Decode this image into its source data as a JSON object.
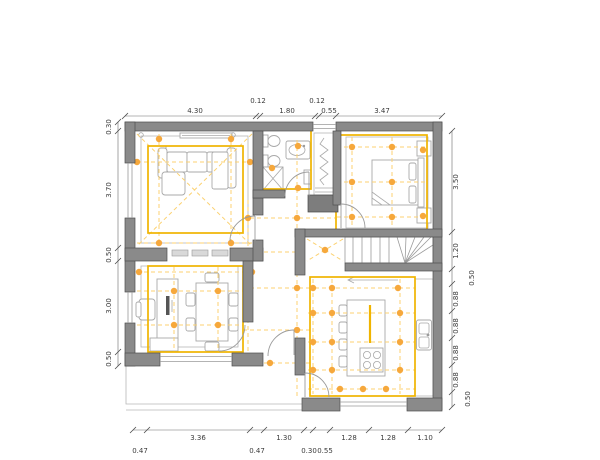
{
  "drawing": {
    "colors": {
      "wall_fill": "#8a8a8a",
      "wall_outline": "#4f4f4f",
      "accent_yellow": "#f0b400",
      "grid_dash_yellow": "#fcd272",
      "light_dot_orange": "#f6a83c",
      "furniture_gray": "#a9a9a9",
      "dimension_text": "#3b3b3b"
    },
    "dims": {
      "top": [
        "4.30",
        "0.12",
        "1.80",
        "0.12",
        "0.55",
        "3.47"
      ],
      "left": [
        "0.30",
        "3.70",
        "0.50",
        "3.00",
        "0.50"
      ],
      "right": [
        "3.50",
        "1.20",
        "0.50",
        "0.88",
        "0.88",
        "0.88",
        "0.88",
        "0.50"
      ],
      "bottom_row1": [
        "3.36",
        "1.30",
        "1.28",
        "1.28",
        "1.10"
      ],
      "bottom_row2": [
        "0.47",
        "0.47",
        "0.30",
        "0.55"
      ]
    }
  }
}
